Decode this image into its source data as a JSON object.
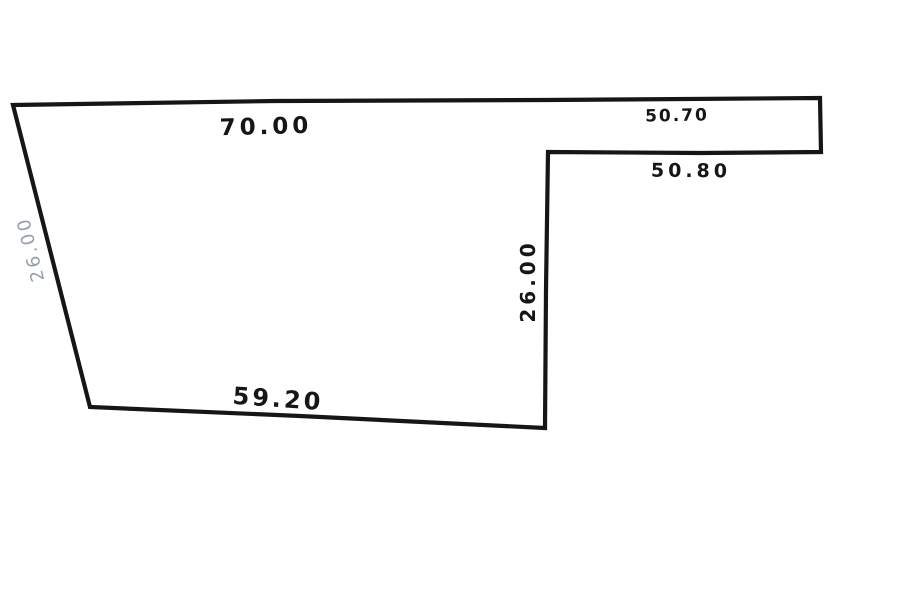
{
  "diagram": {
    "kind": "hand-drawn parcel sketch",
    "background": "#ffffff",
    "ink_color": "#161616",
    "faded_label_color": "#959db0",
    "labels": {
      "top_edge": "70.00",
      "strip_inner": "50.70",
      "strip_outer": "50.80",
      "left_edge": "26.00",
      "middle_edge": "26.00",
      "bottom_edge": "59.20"
    },
    "measurements": [
      {
        "edge": "top",
        "value": "70.00"
      },
      {
        "edge": "top-right strip (inside)",
        "value": "50.70"
      },
      {
        "edge": "top-right strip (below)",
        "value": "50.80"
      },
      {
        "edge": "left slanted",
        "value": "26.00"
      },
      {
        "edge": "middle vertical",
        "value": "26.00"
      },
      {
        "edge": "bottom",
        "value": "59.20"
      }
    ]
  }
}
